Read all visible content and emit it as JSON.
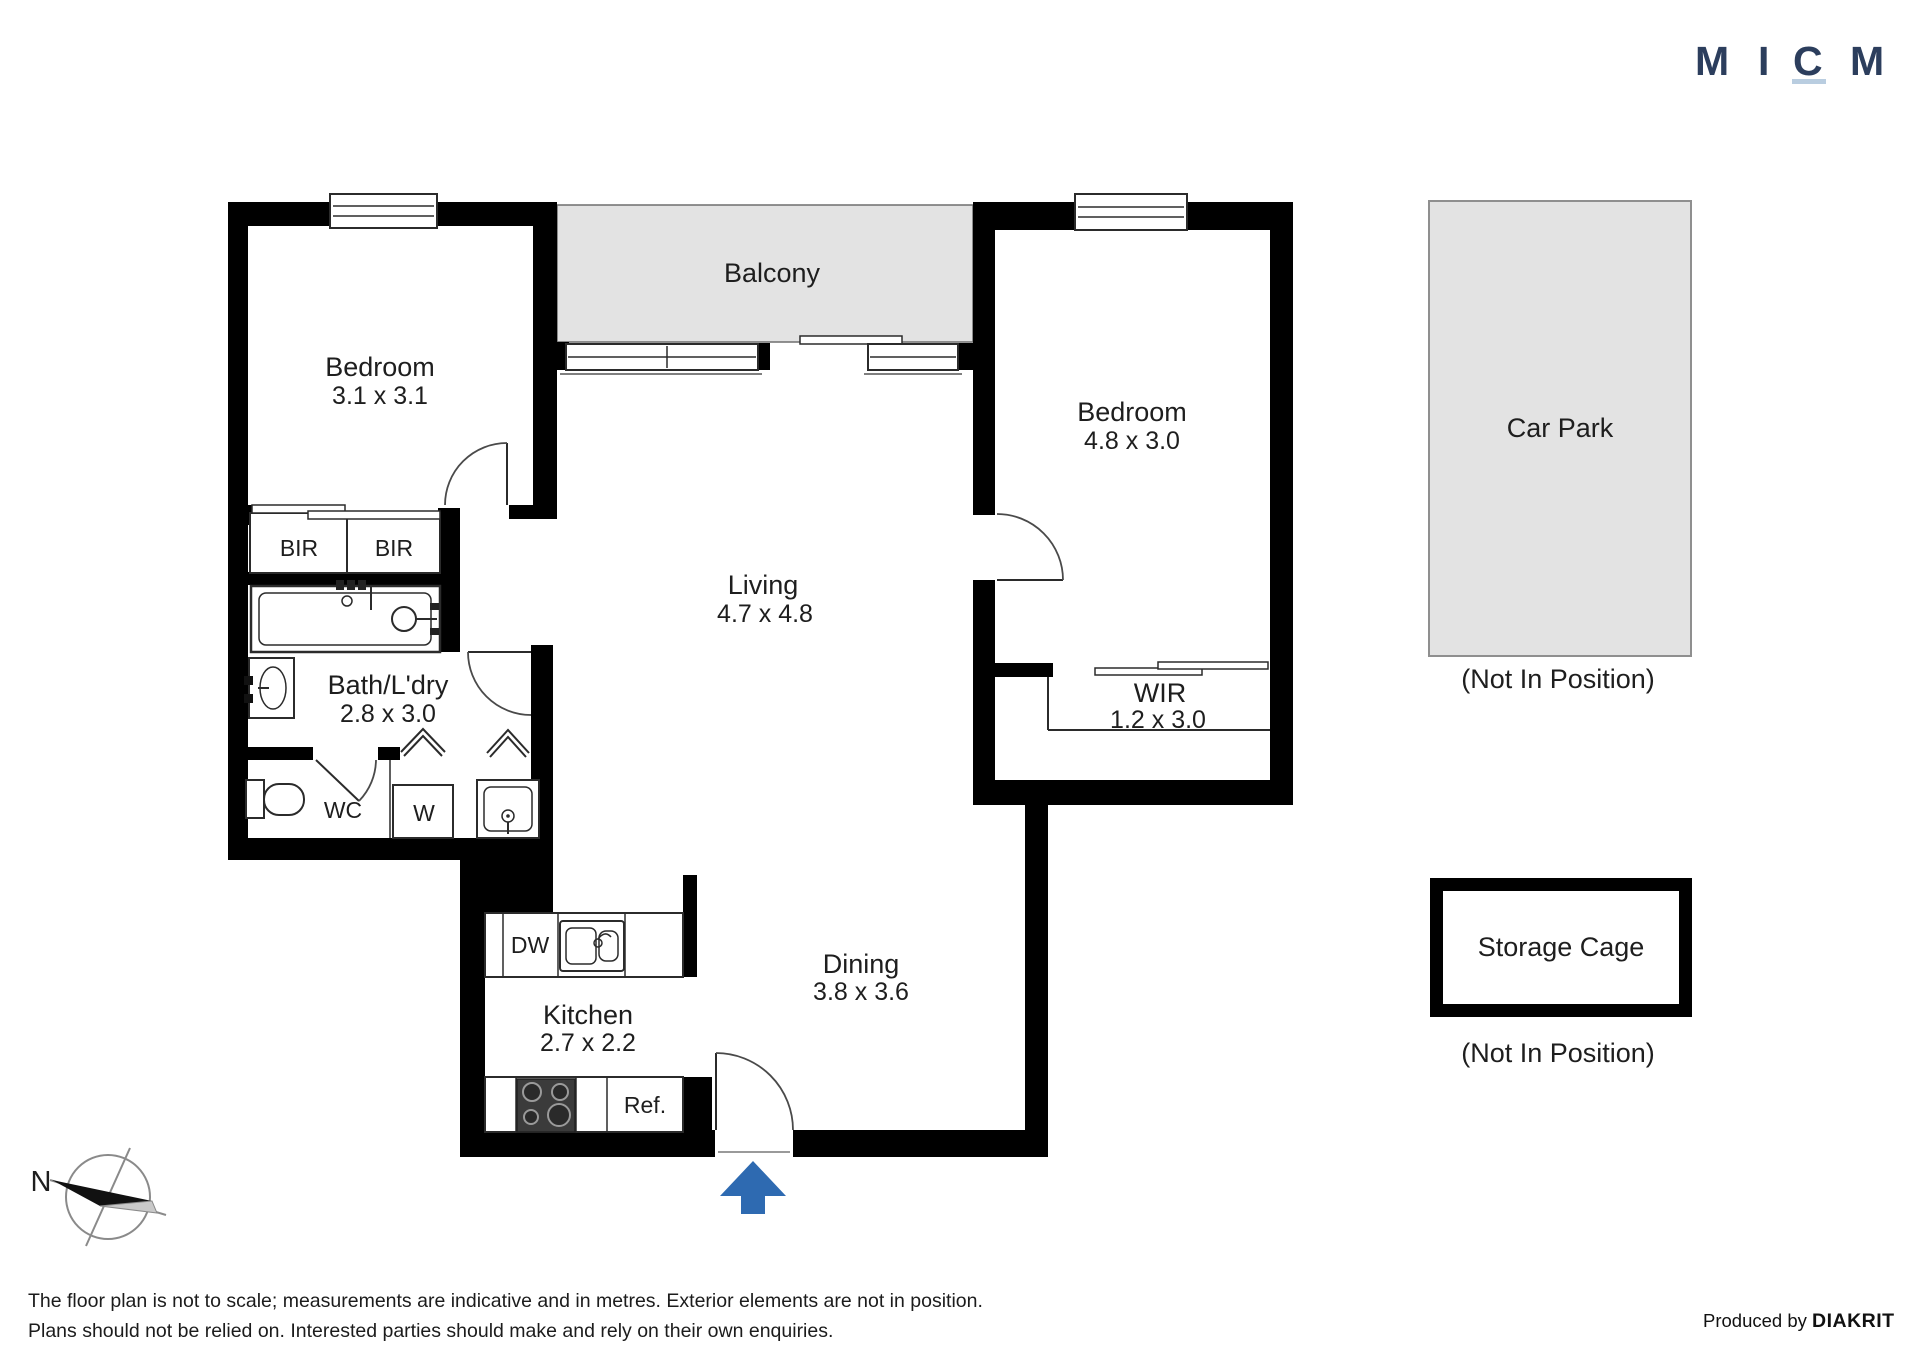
{
  "logo": {
    "letter1": "M",
    "letter2": "I",
    "letter3": "C",
    "letter4": "M"
  },
  "floorplan": {
    "balcony_label": "Balcony",
    "bedroom1_name": "Bedroom",
    "bedroom1_dims": "3.1 x 3.1",
    "bedroom2_name": "Bedroom",
    "bedroom2_dims": "4.8 x 3.0",
    "living_name": "Living",
    "living_dims": "4.7 x 4.8",
    "dining_name": "Dining",
    "dining_dims": "3.8 x 3.6",
    "kitchen_name": "Kitchen",
    "kitchen_dims": "2.7 x 2.2",
    "bath_name": "Bath/L'dry",
    "bath_dims": "2.8 x 3.0",
    "wir_name": "WIR",
    "wir_dims": "1.2 x 3.0",
    "bir_left": "BIR",
    "bir_right": "BIR",
    "wc": "WC",
    "washer": "W",
    "dishwasher": "DW",
    "fridge": "Ref."
  },
  "external": {
    "car_park_label": "Car Park",
    "car_park_note": "(Not In Position)",
    "storage_label": "Storage Cage",
    "storage_note": "(Not In Position)"
  },
  "compass": {
    "north": "N"
  },
  "footer": {
    "line1": "The floor plan is not to scale; measurements are indicative and in metres. Exterior elements are not in position.",
    "line2": "Plans should not be relied on. Interested parties should make and rely on their own enquiries.",
    "credit_prefix": "Produced by ",
    "credit_brand": "DIAKRIT"
  },
  "colors": {
    "wall": "#000000",
    "balcony_fill": "#e3e3e3",
    "carpark_fill": "#e3e3e3",
    "arrow_blue": "#2e6ab1",
    "logo_navy": "#2c3e5d",
    "logo_underline": "#b9cde0"
  }
}
